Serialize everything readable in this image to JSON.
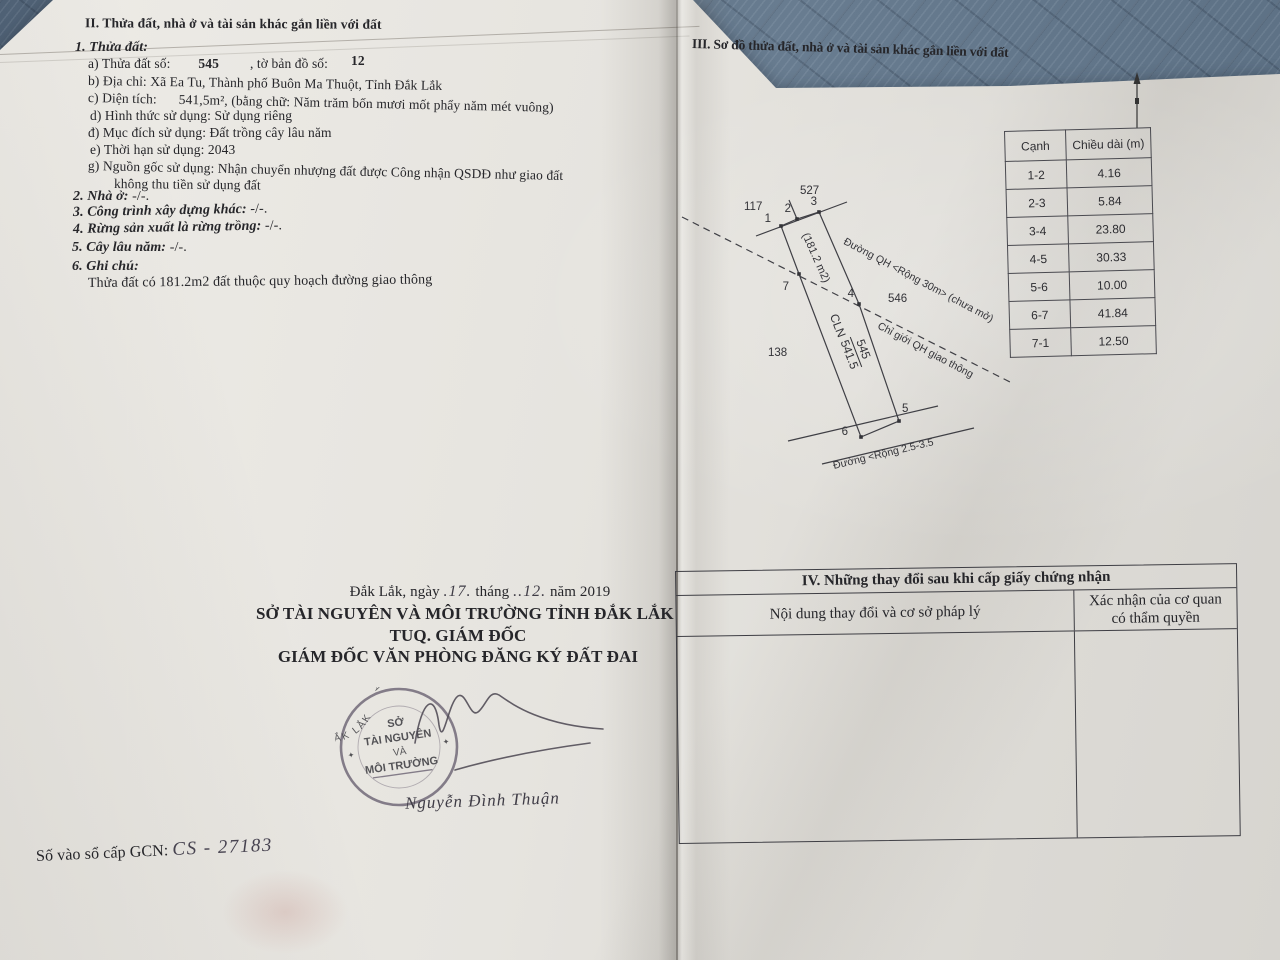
{
  "colors": {
    "fabric": "#5c7084",
    "paper": "#e7e5e0",
    "ink": "#26262a",
    "stamp": "#6e6575"
  },
  "left": {
    "section2_title": "II. Thửa đất, nhà ở và tài sản khác gắn liền với đất",
    "parcel_heading": "1. Thửa đất:",
    "a_label": "a) Thửa đất số:",
    "a_value": "545",
    "a_label2": ", tờ bản đồ số:",
    "a_value2": "12",
    "b_line": "b) Địa chỉ:  Xã Ea Tu, Thành phố Buôn Ma Thuột, Tỉnh Đắk Lắk",
    "c_label": "c) Diện tích:",
    "c_value": "541,5m², (bằng chữ: Năm trăm bốn mươi mốt phẩy năm mét vuông)",
    "d_line": "d) Hình thức sử dụng:  Sử dụng riêng",
    "dd_line": "đ) Mục đích sử dụng:  Đất trồng cây lâu năm",
    "e_line": "e) Thời hạn sử dụng:  2043",
    "g_line1": "g) Nguồn gốc sử dụng: Nhận chuyển nhượng đất được Công nhận QSDĐ như giao đất",
    "g_line2": "không thu tiền sử dụng đất",
    "item2_label": "2. Nhà ở:",
    "item2_value": "-/-.",
    "item3_label": "3. Công trình xây dựng khác:",
    "item3_value": "-/-.",
    "item4_label": "4. Rừng sản xuất là rừng trồng:",
    "item4_value": "-/-.",
    "item5_label": "5. Cây lâu năm:",
    "item5_value": "-/-.",
    "item6_label": "6. Ghi chú:",
    "note_line": "Thửa đất có 181.2m2 đất thuộc quy hoạch đường giao thông",
    "date_pre": "Đắk Lắk, ngày",
    "date_day": ".17.",
    "date_mid": "tháng",
    "date_month": "..12.",
    "date_post": "năm 2019",
    "org_line1": "SỞ TÀI NGUYÊN VÀ MÔI TRƯỜNG TỈNH ĐẮK LẮK",
    "org_line2": "TUQ. GIÁM ĐỐC",
    "org_line3": "GIÁM ĐỐC VĂN PHÒNG ĐĂNG KÝ ĐẤT ĐAI",
    "stamp": {
      "arc_top": "CỘNG HÒA X.H.C.N VIỆT NAM",
      "arc_bottom": "TỈNH ĐẮK LẮK",
      "line1": "SỞ",
      "line2": "TÀI NGUYÊN",
      "line3": "VÀ",
      "line4": "MÔI TRƯỜNG",
      "star_left": "✦",
      "star_right": "✦"
    },
    "signer_name": "Nguyễn Đình Thuận",
    "gcn_label": "Số vào sổ cấp GCN:",
    "gcn_value": "CS - 27183"
  },
  "right": {
    "section3_title": "III. Sơ đồ thửa đất, nhà ở và tài sản khác gắn liền với đất",
    "edge_table": {
      "col1": "Cạnh",
      "col2": "Chiều dài (m)",
      "rows": [
        [
          "1-2",
          "4.16"
        ],
        [
          "2-3",
          "5.84"
        ],
        [
          "3-4",
          "23.80"
        ],
        [
          "4-5",
          "30.33"
        ],
        [
          "5-6",
          "10.00"
        ],
        [
          "6-7",
          "41.84"
        ],
        [
          "7-1",
          "12.50"
        ]
      ]
    },
    "diagram": {
      "v1": "1",
      "v2": "2",
      "v3": "3",
      "v4": "4",
      "v5": "5",
      "v6": "6",
      "v7": "7",
      "n117": "117",
      "n527": "527",
      "n138": "138",
      "n546": "546",
      "area_label": "(181.2 m2)",
      "cln": "CLN",
      "parcel_no": "545",
      "parcel_area": "541.5",
      "road_qh": "Đường QH <Rộng 30m> (chưa mở)",
      "chi_gioi": "Chỉ giới QH giao thông",
      "road_bottom": "Đường <Rộng 2.5-3.5"
    },
    "section4": {
      "title": "IV. Những thay đổi sau khi cấp giấy chứng nhận",
      "col1": "Nội dung thay đổi và cơ sở pháp lý",
      "col2_line1": "Xác nhận của cơ quan",
      "col2_line2": "có thẩm quyền"
    }
  }
}
